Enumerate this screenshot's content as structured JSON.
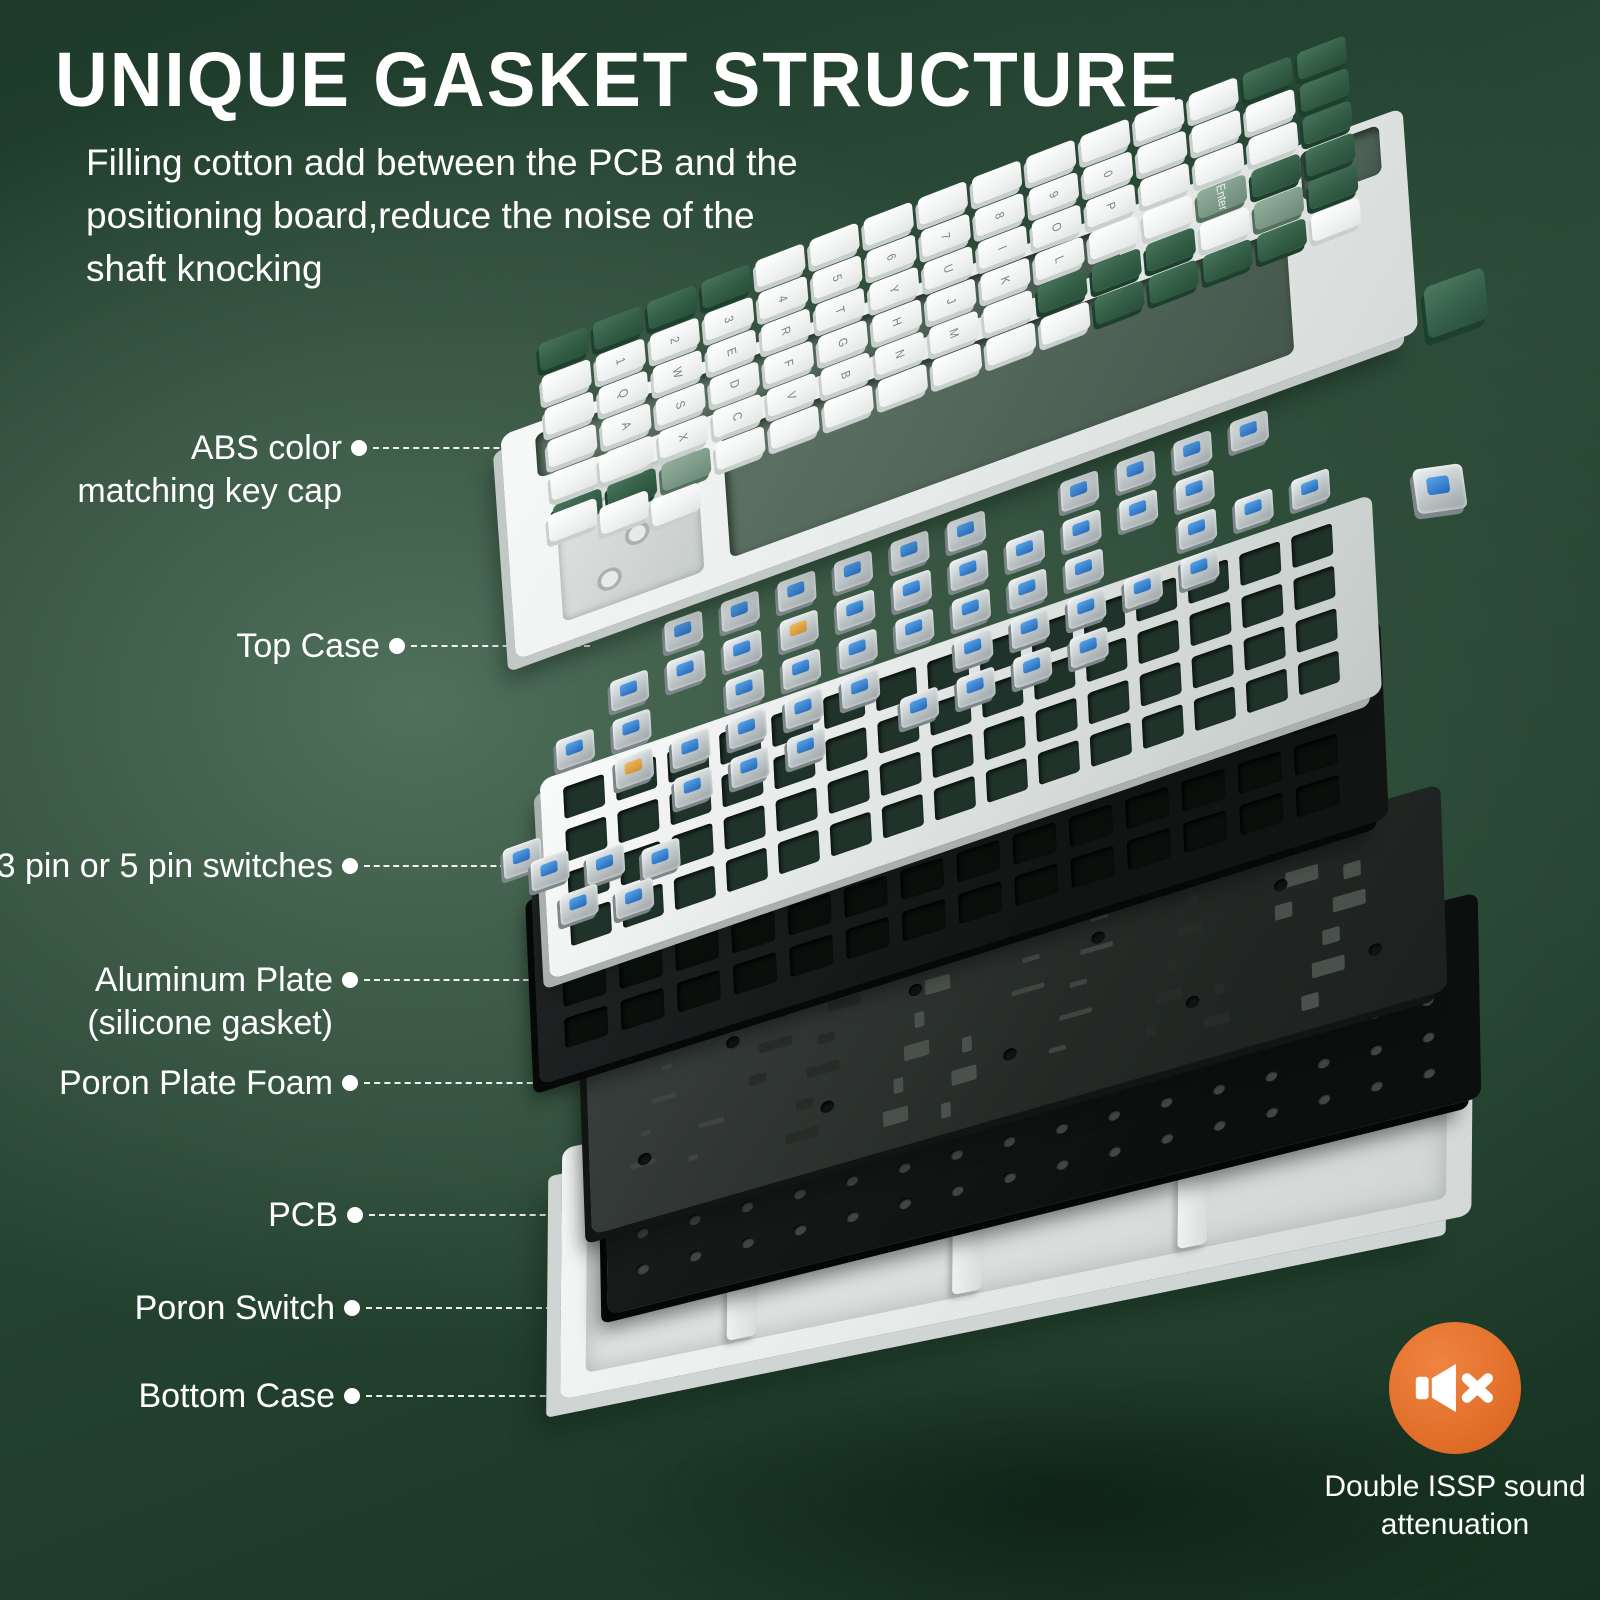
{
  "title": "UNIQUE GASKET STRUCTURE",
  "description": {
    "line1": "Filling cotton add between the PCB and the",
    "line2": "positioning board,reduce the noise of the",
    "line3": "shaft knocking"
  },
  "callouts": [
    {
      "id": "abs-keycap",
      "lines": [
        "ABS color",
        "matching key cap"
      ]
    },
    {
      "id": "top-case",
      "lines": [
        "Top Case"
      ]
    },
    {
      "id": "switches",
      "lines": [
        "3 pin or 5 pin switches"
      ]
    },
    {
      "id": "aluminum-plate",
      "lines": [
        "Aluminum Plate",
        "(silicone gasket)"
      ]
    },
    {
      "id": "poron-plate-foam",
      "lines": [
        "Poron Plate Foam"
      ]
    },
    {
      "id": "pcb",
      "lines": [
        "PCB"
      ]
    },
    {
      "id": "poron-switch",
      "lines": [
        "Poron Switch"
      ]
    },
    {
      "id": "bottom-case",
      "lines": [
        "Bottom Case"
      ]
    }
  ],
  "badge": {
    "icon": "muted-speaker-icon",
    "line1": "Double ISSP sound",
    "line2": "attenuation",
    "background": "#e2702b"
  },
  "keyboard": {
    "layer_names": [
      "ABS color matching key cap",
      "Top Case",
      "3 pin or 5 pin switches",
      "Aluminum Plate (silicone gasket)",
      "Poron Plate Foam",
      "PCB",
      "Poron Switch",
      "Bottom Case"
    ],
    "keycaps": {
      "white": "#f5f7f6",
      "green_dark": "#2f5a42",
      "green_sage": "#7e9b89",
      "enter_label": "Enter",
      "pattern": [
        "GGGGWWWWWWWWWGG",
        "WWWWWWWWWWWWWWG",
        "WWWWWWWWWWWWWWG",
        "WWWWWWWWWWWWSGG",
        "WWWWWWWWWGGGWSG",
        "GGSWWWWWWWGGGGW"
      ],
      "legend_rows": [
        "",
        "1234567890",
        "QWERTYUIOP",
        "ASDFGHJKL",
        "ZXCVBNM",
        ""
      ]
    },
    "switches": {
      "blue": "#2d7fd6",
      "orange": "#e2a23e",
      "pattern": [
        "..BBBBBB.BBBB.",
        ".BBBOBBBBBBB..",
        "BB.BBBBBBB.BBB",
        ".OBBBB.BBBBB..",
        "..BBB.BBBB...."
      ]
    }
  },
  "colors": {
    "background_center": "#4d6a55",
    "background_edge": "#16301f",
    "text": "#ffffff",
    "top_case": "#eef1f0",
    "aluminum_plate": "#e9edec",
    "poron_foam": "#141616",
    "pcb": "#313734",
    "bottom_case": "#eceeed",
    "badge_orange": "#e2702b"
  }
}
